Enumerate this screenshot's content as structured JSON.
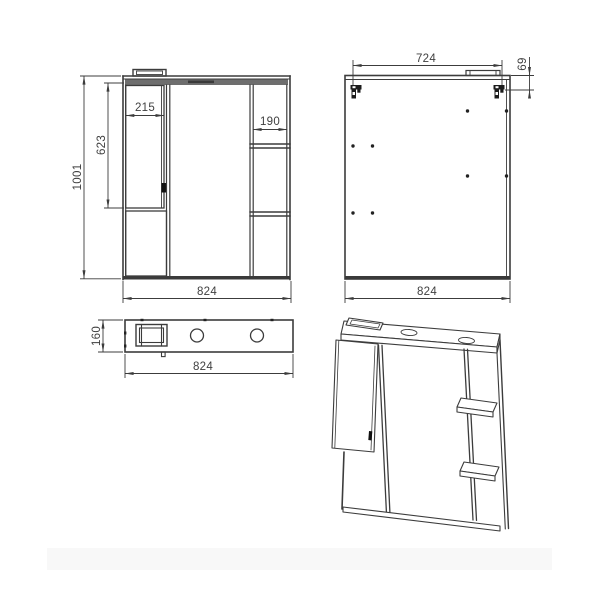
{
  "colors": {
    "line": "#3c3c3c",
    "dim_text": "#3f3f3f",
    "panel_band": "#6e6e6e",
    "accent_black": "#1c1c1c",
    "background": "#ffffff",
    "footer_bar": "#f8f8f8"
  },
  "views": {
    "front": {
      "overall_height": "1001",
      "overall_width": "824",
      "door_width": "215",
      "door_height": "623",
      "shelf_column_width": "190"
    },
    "back": {
      "hanger_span": "724",
      "hanger_top_offset": "69",
      "overall_width": "824"
    },
    "top": {
      "depth": "160",
      "overall_width": "824"
    }
  }
}
